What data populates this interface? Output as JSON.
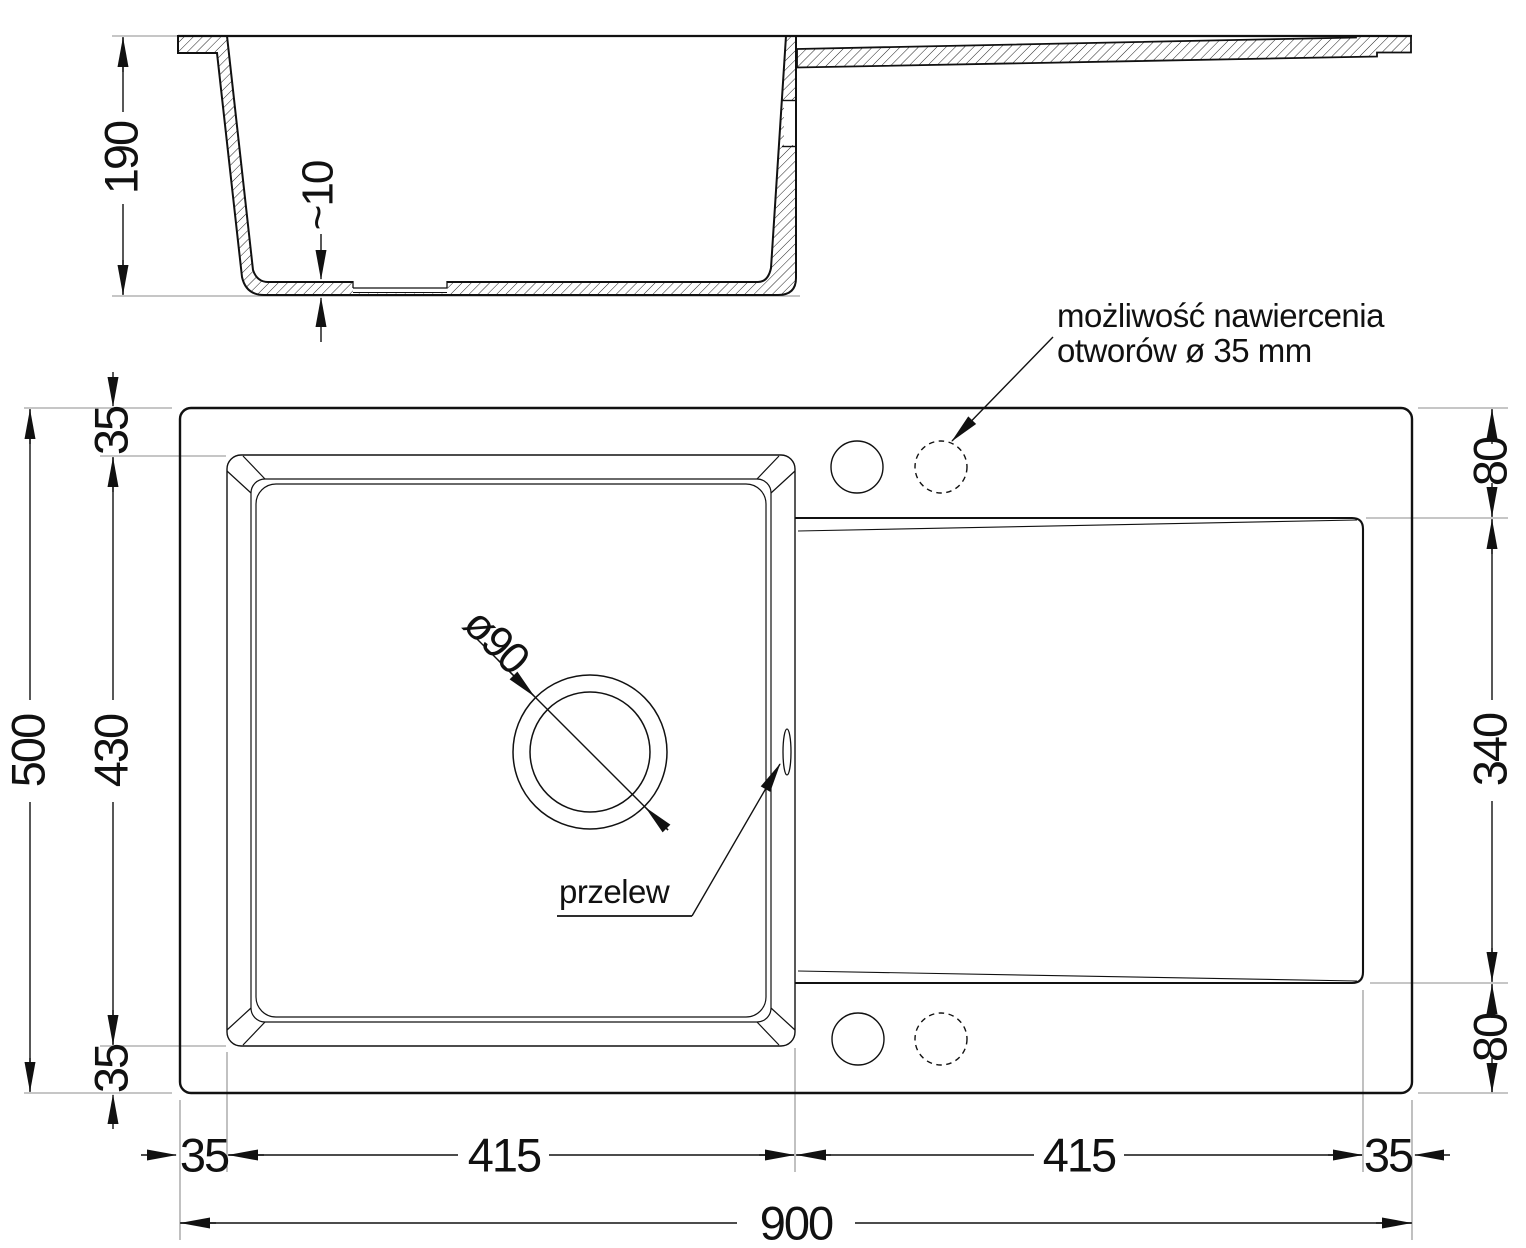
{
  "diagram_title": "sink-technical-drawing",
  "side_view": {
    "depth": "190",
    "base_thickness": "~10"
  },
  "top_view": {
    "drill_note_line1": "możliwość nawiercenia",
    "drill_note_line2": "otworów ø 35 mm",
    "overflow_label": "przelew",
    "drain_diameter": "ø90",
    "dims": {
      "overall_width": "900",
      "overall_depth": "500",
      "left_margin_top": "35",
      "basin_depth": "430",
      "left_margin_bottom": "35",
      "right_top": "80",
      "drainer_depth": "340",
      "right_bottom": "80",
      "bottom_margin_left": "35",
      "basin_width": "415",
      "drainer_width": "415",
      "bottom_margin_right": "35"
    }
  },
  "colors": {
    "line": "#111111",
    "extension_line": "#8e8e8e",
    "background": "#ffffff"
  }
}
